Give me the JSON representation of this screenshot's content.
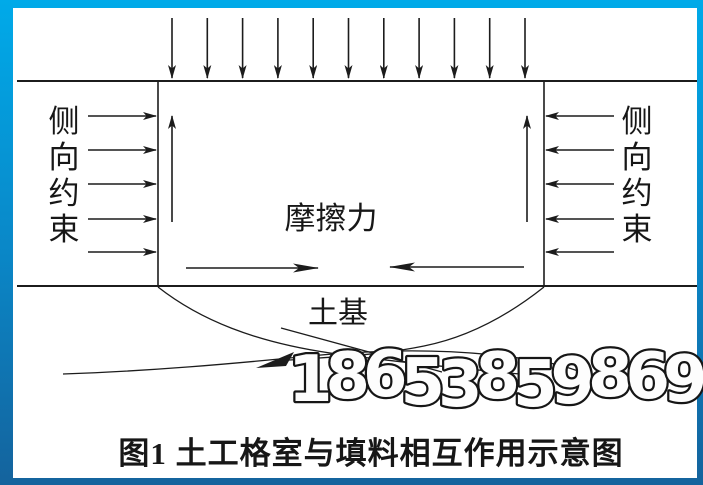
{
  "figure": {
    "caption": "图1  土工格室与填料相互作用示意图",
    "watermark": "18653859869"
  },
  "diagram": {
    "left_label": "侧向约束",
    "right_label": "侧向约束",
    "friction_label": "摩擦力",
    "soil_label": "土基",
    "top_load_arrow_count": 11,
    "side_arrow_count_each": 5,
    "internal_up_arrow_count": 2
  },
  "colors": {
    "frame_top": "#00aae9",
    "frame_bottom": "#14639d",
    "background": "#ffffff",
    "line": "#1c1c1c",
    "watermark_fill": "#fdfdfd",
    "watermark_outline": "#161616"
  }
}
